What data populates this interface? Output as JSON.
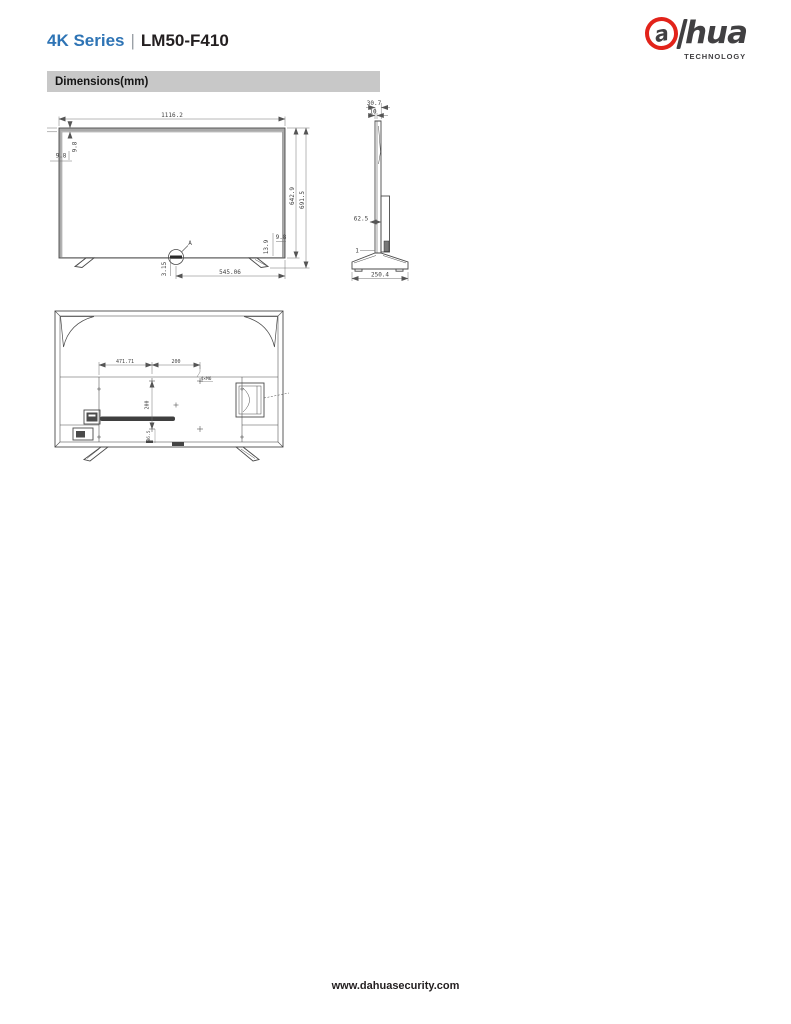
{
  "header": {
    "series": "4K Series",
    "separator": "|",
    "model": "LM50-F410"
  },
  "logo": {
    "a": "a",
    "rest": "hua",
    "tagline": "TECHNOLOGY",
    "brand_red": "#e2231a",
    "brand_dark": "#414042"
  },
  "section": {
    "title": "Dimensions(mm)"
  },
  "colors": {
    "accent_blue": "#2e74b5",
    "bar_gray": "#c8c8c8",
    "line": "#4a4a4a",
    "ink": "#231f20"
  },
  "views": {
    "front": {
      "dims": {
        "overall_width": "1116.2",
        "bezel_top": "9.8",
        "bezel_side": "9.8",
        "panel_height": "642.9",
        "overall_height": "691.5",
        "bottom_bezel": "13.9",
        "bottom_side": "9.8",
        "detail_offset": "3.15",
        "stand_span": "545.06",
        "detail_label": "A"
      }
    },
    "side": {
      "dims": {
        "top_depth": "30.7",
        "panel_thickness": "10",
        "rear_depth": "62.5",
        "gap": "1",
        "base_depth": "250.4"
      }
    },
    "rear": {
      "dims": {
        "vesa_left_offset": "471.71",
        "vesa_width": "200",
        "vesa_height": "200",
        "screw_spec": "4×M6",
        "bottom_offset": "86.5"
      }
    }
  },
  "footer": {
    "url": "www.dahuasecurity.com"
  }
}
